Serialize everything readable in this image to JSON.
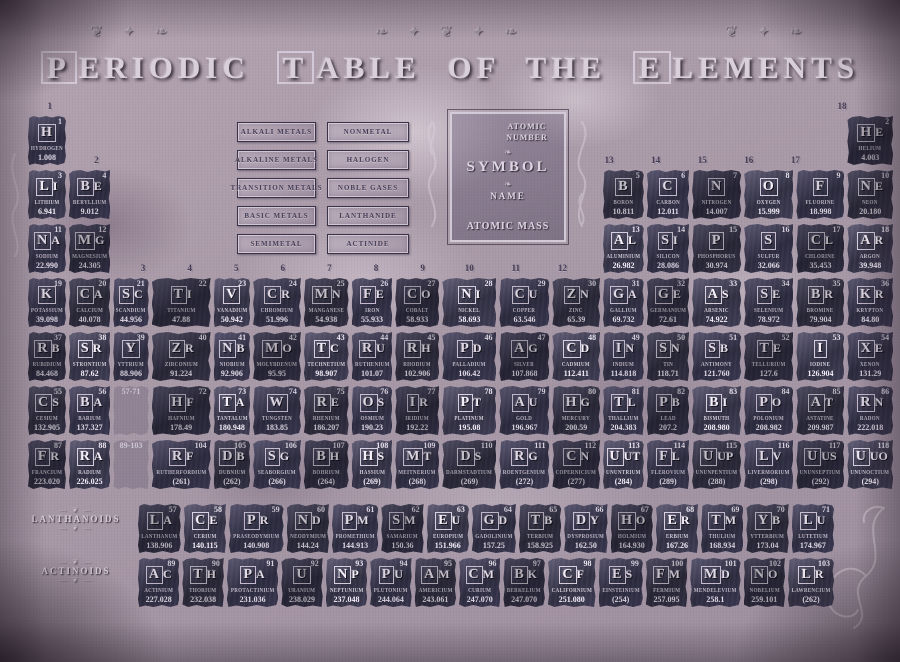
{
  "title": "PERIODIC TABLE OF THE ELEMENTS",
  "colors": {
    "background": "#ab99a9",
    "tile": "#3d3b56",
    "tile_text": "#d9d2de",
    "title_text": "#d8cfda",
    "label_dark": "#443c56"
  },
  "ornaments": {
    "top_band": [
      "❦ ✦ ❧",
      "❧ ✦ ❦ ✦ ❧",
      "❦ ✦ ❧"
    ],
    "divider": "❧",
    "scroll_line": "— ❦ —"
  },
  "legend": {
    "left": [
      "ALKALI METALS",
      "ALKALINE METALS",
      "TRANSITION METALS",
      "BASIC METALS",
      "SEMIMETAL"
    ],
    "right": [
      "NONMETAL",
      "HALOGEN",
      "NOBLE GASES",
      "LANTHANIDE",
      "ACTINIDE"
    ]
  },
  "key": {
    "atomic_number": "ATOMIC NUMBER",
    "symbol": "SYMBOL",
    "name": "NAME",
    "atomic_mass": "ATOMIC MASS"
  },
  "side_labels": {
    "lanthanoids": "LANTHANOIDS",
    "actinoids": "ACTINOIDS"
  },
  "placeholders": {
    "lanthanide_range": {
      "text": "57-71",
      "row": 6,
      "col": 3
    },
    "actinide_range": {
      "text": "89-103",
      "row": 7,
      "col": 3
    }
  },
  "group_labels": [
    {
      "t": "1",
      "c": 1,
      "lvl": 1
    },
    {
      "t": "2",
      "c": 2,
      "lvl": 2
    },
    {
      "t": "3",
      "c": 3,
      "lvl": 4
    },
    {
      "t": "4",
      "c": 4,
      "lvl": 4
    },
    {
      "t": "5",
      "c": 5,
      "lvl": 4
    },
    {
      "t": "6",
      "c": 6,
      "lvl": 4
    },
    {
      "t": "7",
      "c": 7,
      "lvl": 4
    },
    {
      "t": "8",
      "c": 8,
      "lvl": 4
    },
    {
      "t": "9",
      "c": 9,
      "lvl": 4
    },
    {
      "t": "10",
      "c": 10,
      "lvl": 4
    },
    {
      "t": "11",
      "c": 11,
      "lvl": 4
    },
    {
      "t": "12",
      "c": 12,
      "lvl": 4
    },
    {
      "t": "13",
      "c": 13,
      "lvl": 2
    },
    {
      "t": "14",
      "c": 14,
      "lvl": 2
    },
    {
      "t": "15",
      "c": 15,
      "lvl": 2
    },
    {
      "t": "16",
      "c": 16,
      "lvl": 2
    },
    {
      "t": "17",
      "c": 17,
      "lvl": 2
    },
    {
      "t": "18",
      "c": 18,
      "lvl": 1
    }
  ],
  "elements": [
    {
      "n": 1,
      "s": "H",
      "name": "HYDROGEN",
      "m": "1.008",
      "p": 1,
      "g": 1
    },
    {
      "n": 2,
      "s": "HE",
      "name": "HELIUM",
      "m": "4.003",
      "p": 1,
      "g": 18
    },
    {
      "n": 3,
      "s": "LI",
      "name": "LITHIUM",
      "m": "6.941",
      "p": 2,
      "g": 1
    },
    {
      "n": 4,
      "s": "BE",
      "name": "BERYLLIUM",
      "m": "9.012",
      "p": 2,
      "g": 2
    },
    {
      "n": 5,
      "s": "B",
      "name": "BORON",
      "m": "10.811",
      "p": 2,
      "g": 13
    },
    {
      "n": 6,
      "s": "C",
      "name": "CARBON",
      "m": "12.011",
      "p": 2,
      "g": 14
    },
    {
      "n": 7,
      "s": "N",
      "name": "NITROGEN",
      "m": "14.007",
      "p": 2,
      "g": 15
    },
    {
      "n": 8,
      "s": "O",
      "name": "OXYGEN",
      "m": "15.999",
      "p": 2,
      "g": 16
    },
    {
      "n": 9,
      "s": "F",
      "name": "FLUORINE",
      "m": "18.998",
      "p": 2,
      "g": 17
    },
    {
      "n": 10,
      "s": "NE",
      "name": "NEON",
      "m": "20.180",
      "p": 2,
      "g": 18
    },
    {
      "n": 11,
      "s": "NA",
      "name": "SODIUM",
      "m": "22.990",
      "p": 3,
      "g": 1
    },
    {
      "n": 12,
      "s": "MG",
      "name": "MAGNESIUM",
      "m": "24.305",
      "p": 3,
      "g": 2
    },
    {
      "n": 13,
      "s": "AL",
      "name": "ALUMINIUM",
      "m": "26.982",
      "p": 3,
      "g": 13
    },
    {
      "n": 14,
      "s": "SI",
      "name": "SILICON",
      "m": "28.086",
      "p": 3,
      "g": 14
    },
    {
      "n": 15,
      "s": "P",
      "name": "PHOSPHORUS",
      "m": "30.974",
      "p": 3,
      "g": 15
    },
    {
      "n": 16,
      "s": "S",
      "name": "SULFUR",
      "m": "32.066",
      "p": 3,
      "g": 16
    },
    {
      "n": 17,
      "s": "CL",
      "name": "CHLORINE",
      "m": "35.453",
      "p": 3,
      "g": 17
    },
    {
      "n": 18,
      "s": "AR",
      "name": "ARGON",
      "m": "39.948",
      "p": 3,
      "g": 18
    },
    {
      "n": 19,
      "s": "K",
      "name": "POTASSIUM",
      "m": "39.098",
      "p": 4,
      "g": 1
    },
    {
      "n": 20,
      "s": "CA",
      "name": "CALCIUM",
      "m": "40.078",
      "p": 4,
      "g": 2
    },
    {
      "n": 21,
      "s": "SC",
      "name": "SCANDIUM",
      "m": "44.956",
      "p": 4,
      "g": 3
    },
    {
      "n": 22,
      "s": "TI",
      "name": "TITANIUM",
      "m": "47.88",
      "p": 4,
      "g": 4
    },
    {
      "n": 23,
      "s": "V",
      "name": "VANADIUM",
      "m": "50.942",
      "p": 4,
      "g": 5
    },
    {
      "n": 24,
      "s": "CR",
      "name": "CHROMIUM",
      "m": "51.996",
      "p": 4,
      "g": 6
    },
    {
      "n": 25,
      "s": "MN",
      "name": "MANGANESE",
      "m": "54.938",
      "p": 4,
      "g": 7
    },
    {
      "n": 26,
      "s": "FE",
      "name": "IRON",
      "m": "55.933",
      "p": 4,
      "g": 8
    },
    {
      "n": 27,
      "s": "CO",
      "name": "COBALT",
      "m": "58.933",
      "p": 4,
      "g": 9
    },
    {
      "n": 28,
      "s": "NI",
      "name": "NICKEL",
      "m": "58.693",
      "p": 4,
      "g": 10
    },
    {
      "n": 29,
      "s": "CU",
      "name": "COPPER",
      "m": "63.546",
      "p": 4,
      "g": 11
    },
    {
      "n": 30,
      "s": "ZN",
      "name": "ZINC",
      "m": "65.39",
      "p": 4,
      "g": 12
    },
    {
      "n": 31,
      "s": "GA",
      "name": "GALLIUM",
      "m": "69.732",
      "p": 4,
      "g": 13
    },
    {
      "n": 32,
      "s": "GE",
      "name": "GERMANIUM",
      "m": "72.61",
      "p": 4,
      "g": 14
    },
    {
      "n": 33,
      "s": "AS",
      "name": "ARSENIC",
      "m": "74.922",
      "p": 4,
      "g": 15
    },
    {
      "n": 34,
      "s": "SE",
      "name": "SELENIUM",
      "m": "78.972",
      "p": 4,
      "g": 16
    },
    {
      "n": 35,
      "s": "BR",
      "name": "BROMINE",
      "m": "79.904",
      "p": 4,
      "g": 17
    },
    {
      "n": 36,
      "s": "KR",
      "name": "KRYPTON",
      "m": "84.80",
      "p": 4,
      "g": 18
    },
    {
      "n": 37,
      "s": "RB",
      "name": "RUBIDIUM",
      "m": "84.468",
      "p": 5,
      "g": 1
    },
    {
      "n": 38,
      "s": "SR",
      "name": "STRONTIUM",
      "m": "87.62",
      "p": 5,
      "g": 2
    },
    {
      "n": 39,
      "s": "Y",
      "name": "YTTRIUM",
      "m": "88.906",
      "p": 5,
      "g": 3
    },
    {
      "n": 40,
      "s": "ZR",
      "name": "ZIRCONIUM",
      "m": "91.224",
      "p": 5,
      "g": 4
    },
    {
      "n": 41,
      "s": "NB",
      "name": "NIOBIUM",
      "m": "92.906",
      "p": 5,
      "g": 5
    },
    {
      "n": 42,
      "s": "MO",
      "name": "MOLYBDENUM",
      "m": "95.95",
      "p": 5,
      "g": 6
    },
    {
      "n": 43,
      "s": "TC",
      "name": "TECHNETIUM",
      "m": "98.907",
      "p": 5,
      "g": 7
    },
    {
      "n": 44,
      "s": "RU",
      "name": "RUTHENIUM",
      "m": "101.07",
      "p": 5,
      "g": 8
    },
    {
      "n": 45,
      "s": "RH",
      "name": "RHODIUM",
      "m": "102.906",
      "p": 5,
      "g": 9
    },
    {
      "n": 46,
      "s": "PD",
      "name": "PALLADIUM",
      "m": "106.42",
      "p": 5,
      "g": 10
    },
    {
      "n": 47,
      "s": "AG",
      "name": "SILVER",
      "m": "107.868",
      "p": 5,
      "g": 11
    },
    {
      "n": 48,
      "s": "CD",
      "name": "CADMIUM",
      "m": "112.411",
      "p": 5,
      "g": 12
    },
    {
      "n": 49,
      "s": "IN",
      "name": "INDIUM",
      "m": "114.818",
      "p": 5,
      "g": 13
    },
    {
      "n": 50,
      "s": "SN",
      "name": "TIN",
      "m": "118.71",
      "p": 5,
      "g": 14
    },
    {
      "n": 51,
      "s": "SB",
      "name": "ANTIMONY",
      "m": "121.760",
      "p": 5,
      "g": 15
    },
    {
      "n": 52,
      "s": "TE",
      "name": "TELLURIUM",
      "m": "127.6",
      "p": 5,
      "g": 16
    },
    {
      "n": 53,
      "s": "I",
      "name": "IODINE",
      "m": "126.904",
      "p": 5,
      "g": 17
    },
    {
      "n": 54,
      "s": "XE",
      "name": "XENON",
      "m": "131.29",
      "p": 5,
      "g": 18
    },
    {
      "n": 55,
      "s": "CS",
      "name": "CESIUM",
      "m": "132.905",
      "p": 6,
      "g": 1
    },
    {
      "n": 56,
      "s": "BA",
      "name": "BARIUM",
      "m": "137.327",
      "p": 6,
      "g": 2
    },
    {
      "n": 72,
      "s": "HF",
      "name": "HAFNIUM",
      "m": "178.49",
      "p": 6,
      "g": 4
    },
    {
      "n": 73,
      "s": "TA",
      "name": "TANTALUM",
      "m": "180.948",
      "p": 6,
      "g": 5
    },
    {
      "n": 74,
      "s": "W",
      "name": "TUNGSTEN",
      "m": "183.85",
      "p": 6,
      "g": 6
    },
    {
      "n": 75,
      "s": "RE",
      "name": "RHENIUM",
      "m": "186.207",
      "p": 6,
      "g": 7
    },
    {
      "n": 76,
      "s": "OS",
      "name": "OSMIUM",
      "m": "190.23",
      "p": 6,
      "g": 8
    },
    {
      "n": 77,
      "s": "IR",
      "name": "IRIDIUM",
      "m": "192.22",
      "p": 6,
      "g": 9
    },
    {
      "n": 78,
      "s": "PT",
      "name": "PLATINUM",
      "m": "195.08",
      "p": 6,
      "g": 10
    },
    {
      "n": 79,
      "s": "AU",
      "name": "GOLD",
      "m": "196.967",
      "p": 6,
      "g": 11
    },
    {
      "n": 80,
      "s": "HG",
      "name": "MERCURY",
      "m": "200.59",
      "p": 6,
      "g": 12
    },
    {
      "n": 81,
      "s": "TL",
      "name": "THALLIUM",
      "m": "204.383",
      "p": 6,
      "g": 13
    },
    {
      "n": 82,
      "s": "PB",
      "name": "LEAD",
      "m": "207.2",
      "p": 6,
      "g": 14
    },
    {
      "n": 83,
      "s": "BI",
      "name": "BISMUTH",
      "m": "208.980",
      "p": 6,
      "g": 15
    },
    {
      "n": 84,
      "s": "PO",
      "name": "POLONIUM",
      "m": "208.982",
      "p": 6,
      "g": 16
    },
    {
      "n": 85,
      "s": "AT",
      "name": "ASTATINE",
      "m": "209.987",
      "p": 6,
      "g": 17
    },
    {
      "n": 86,
      "s": "RN",
      "name": "RADON",
      "m": "222.018",
      "p": 6,
      "g": 18
    },
    {
      "n": 87,
      "s": "FR",
      "name": "FRANCIUM",
      "m": "223.020",
      "p": 7,
      "g": 1
    },
    {
      "n": 88,
      "s": "RA",
      "name": "RADIUM",
      "m": "226.025",
      "p": 7,
      "g": 2
    },
    {
      "n": 104,
      "s": "RF",
      "name": "RUTHERFORDIUM",
      "m": "(261)",
      "p": 7,
      "g": 4
    },
    {
      "n": 105,
      "s": "DB",
      "name": "DUBNIUM",
      "m": "(262)",
      "p": 7,
      "g": 5
    },
    {
      "n": 106,
      "s": "SG",
      "name": "SEABORGIUM",
      "m": "(266)",
      "p": 7,
      "g": 6
    },
    {
      "n": 107,
      "s": "BH",
      "name": "BOHRIUM",
      "m": "(264)",
      "p": 7,
      "g": 7
    },
    {
      "n": 108,
      "s": "HS",
      "name": "HASSIUM",
      "m": "(269)",
      "p": 7,
      "g": 8
    },
    {
      "n": 109,
      "s": "MT",
      "name": "MEITNERIUM",
      "m": "(268)",
      "p": 7,
      "g": 9
    },
    {
      "n": 110,
      "s": "DS",
      "name": "DARMSTADTIUM",
      "m": "(269)",
      "p": 7,
      "g": 10
    },
    {
      "n": 111,
      "s": "RG",
      "name": "ROENTGENIUM",
      "m": "(272)",
      "p": 7,
      "g": 11
    },
    {
      "n": 112,
      "s": "CN",
      "name": "COPERNICIUM",
      "m": "(277)",
      "p": 7,
      "g": 12
    },
    {
      "n": 113,
      "s": "UUT",
      "name": "UNUNTRIUM",
      "m": "(284)",
      "p": 7,
      "g": 13
    },
    {
      "n": 114,
      "s": "FL",
      "name": "FLEROVIUM",
      "m": "(289)",
      "p": 7,
      "g": 14
    },
    {
      "n": 115,
      "s": "UUP",
      "name": "UNUNPENTIUM",
      "m": "(288)",
      "p": 7,
      "g": 15
    },
    {
      "n": 116,
      "s": "LV",
      "name": "LIVERMORIUM",
      "m": "(298)",
      "p": 7,
      "g": 16
    },
    {
      "n": 117,
      "s": "UUS",
      "name": "UNUNSEPTIUM",
      "m": "(292)",
      "p": 7,
      "g": 17
    },
    {
      "n": 118,
      "s": "UUO",
      "name": "UNUNOCTIUM",
      "m": "(294)",
      "p": 7,
      "g": 18
    }
  ],
  "lanthanides": [
    {
      "n": 57,
      "s": "LA",
      "name": "LANTHANUM",
      "m": "138.906"
    },
    {
      "n": 58,
      "s": "CE",
      "name": "CERIUM",
      "m": "140.115"
    },
    {
      "n": 59,
      "s": "PR",
      "name": "PRASEODYMIUM",
      "m": "140.908"
    },
    {
      "n": 60,
      "s": "ND",
      "name": "NEODYMIUM",
      "m": "144.24"
    },
    {
      "n": 61,
      "s": "PM",
      "name": "PROMETHIUM",
      "m": "144.913"
    },
    {
      "n": 62,
      "s": "SM",
      "name": "SAMARIUM",
      "m": "150.36"
    },
    {
      "n": 63,
      "s": "EU",
      "name": "EUROPIUM",
      "m": "151.966"
    },
    {
      "n": 64,
      "s": "GD",
      "name": "GADOLINIUM",
      "m": "157.25"
    },
    {
      "n": 65,
      "s": "TB",
      "name": "TERBIUM",
      "m": "158.925"
    },
    {
      "n": 66,
      "s": "DY",
      "name": "DYSPROSIUM",
      "m": "162.50"
    },
    {
      "n": 67,
      "s": "HO",
      "name": "HOLMIUM",
      "m": "164.930"
    },
    {
      "n": 68,
      "s": "ER",
      "name": "ERBIUM",
      "m": "167.26"
    },
    {
      "n": 69,
      "s": "TM",
      "name": "THULIUM",
      "m": "168.934"
    },
    {
      "n": 70,
      "s": "YB",
      "name": "YTTERBIUM",
      "m": "173.04"
    },
    {
      "n": 71,
      "s": "LU",
      "name": "LUTETIUM",
      "m": "174.967"
    }
  ],
  "actinides": [
    {
      "n": 89,
      "s": "AC",
      "name": "ACTINIUM",
      "m": "227.028"
    },
    {
      "n": 90,
      "s": "TH",
      "name": "THORIUM",
      "m": "232.038"
    },
    {
      "n": 91,
      "s": "PA",
      "name": "PROTACTINIUM",
      "m": "231.036"
    },
    {
      "n": 92,
      "s": "U",
      "name": "URANIUM",
      "m": "238.029"
    },
    {
      "n": 93,
      "s": "NP",
      "name": "NEPTUNIUM",
      "m": "237.048"
    },
    {
      "n": 94,
      "s": "PU",
      "name": "PLUTONIUM",
      "m": "244.064"
    },
    {
      "n": 95,
      "s": "AM",
      "name": "AMERICIUM",
      "m": "243.061"
    },
    {
      "n": 96,
      "s": "CM",
      "name": "CURIUM",
      "m": "247.070"
    },
    {
      "n": 97,
      "s": "BK",
      "name": "BERKELIUM",
      "m": "247.070"
    },
    {
      "n": 98,
      "s": "CF",
      "name": "CALIFORNIUM",
      "m": "251.080"
    },
    {
      "n": 99,
      "s": "ES",
      "name": "EINSTEINIUM",
      "m": "(254)"
    },
    {
      "n": 100,
      "s": "FM",
      "name": "FERMIUM",
      "m": "257.095"
    },
    {
      "n": 101,
      "s": "MD",
      "name": "MENDELEVIUM",
      "m": "258.1"
    },
    {
      "n": 102,
      "s": "NO",
      "name": "NOBELIUM",
      "m": "259.101"
    },
    {
      "n": 103,
      "s": "LR",
      "name": "LAWRENCIUM",
      "m": "(262)"
    }
  ]
}
